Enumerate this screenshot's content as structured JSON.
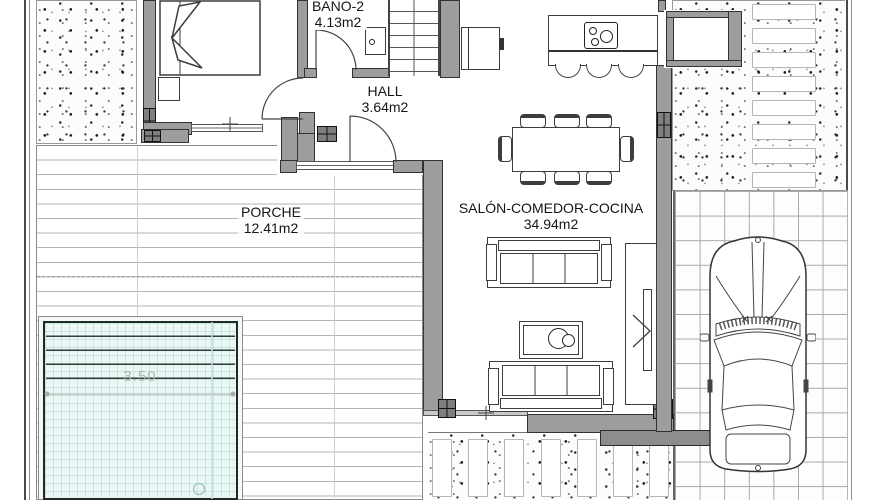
{
  "document": {
    "type": "architectural floor plan"
  },
  "rooms": {
    "bano2": {
      "name": "BANO-2",
      "area": "4.13m2"
    },
    "hall": {
      "name": "HALL",
      "area": "3.64m2"
    },
    "porche": {
      "name": "PORCHE",
      "area": "12.41m2"
    },
    "salon": {
      "name": "SALÓN-COMEDOR-COCINA",
      "area": "34.94m2"
    }
  },
  "pool": {
    "width_dimension": "3.50"
  },
  "colors": {
    "wall_fill": "#9d9d9d",
    "wall_outline": "#333333",
    "pool_water": "#eaf8f5",
    "pool_grid": "#6eb9ac",
    "dimension_text": "#b4b4b4",
    "furniture_line": "#3d3d3d",
    "deck_line": "#b3b3b3",
    "tile_line": "#a8a8a8"
  }
}
